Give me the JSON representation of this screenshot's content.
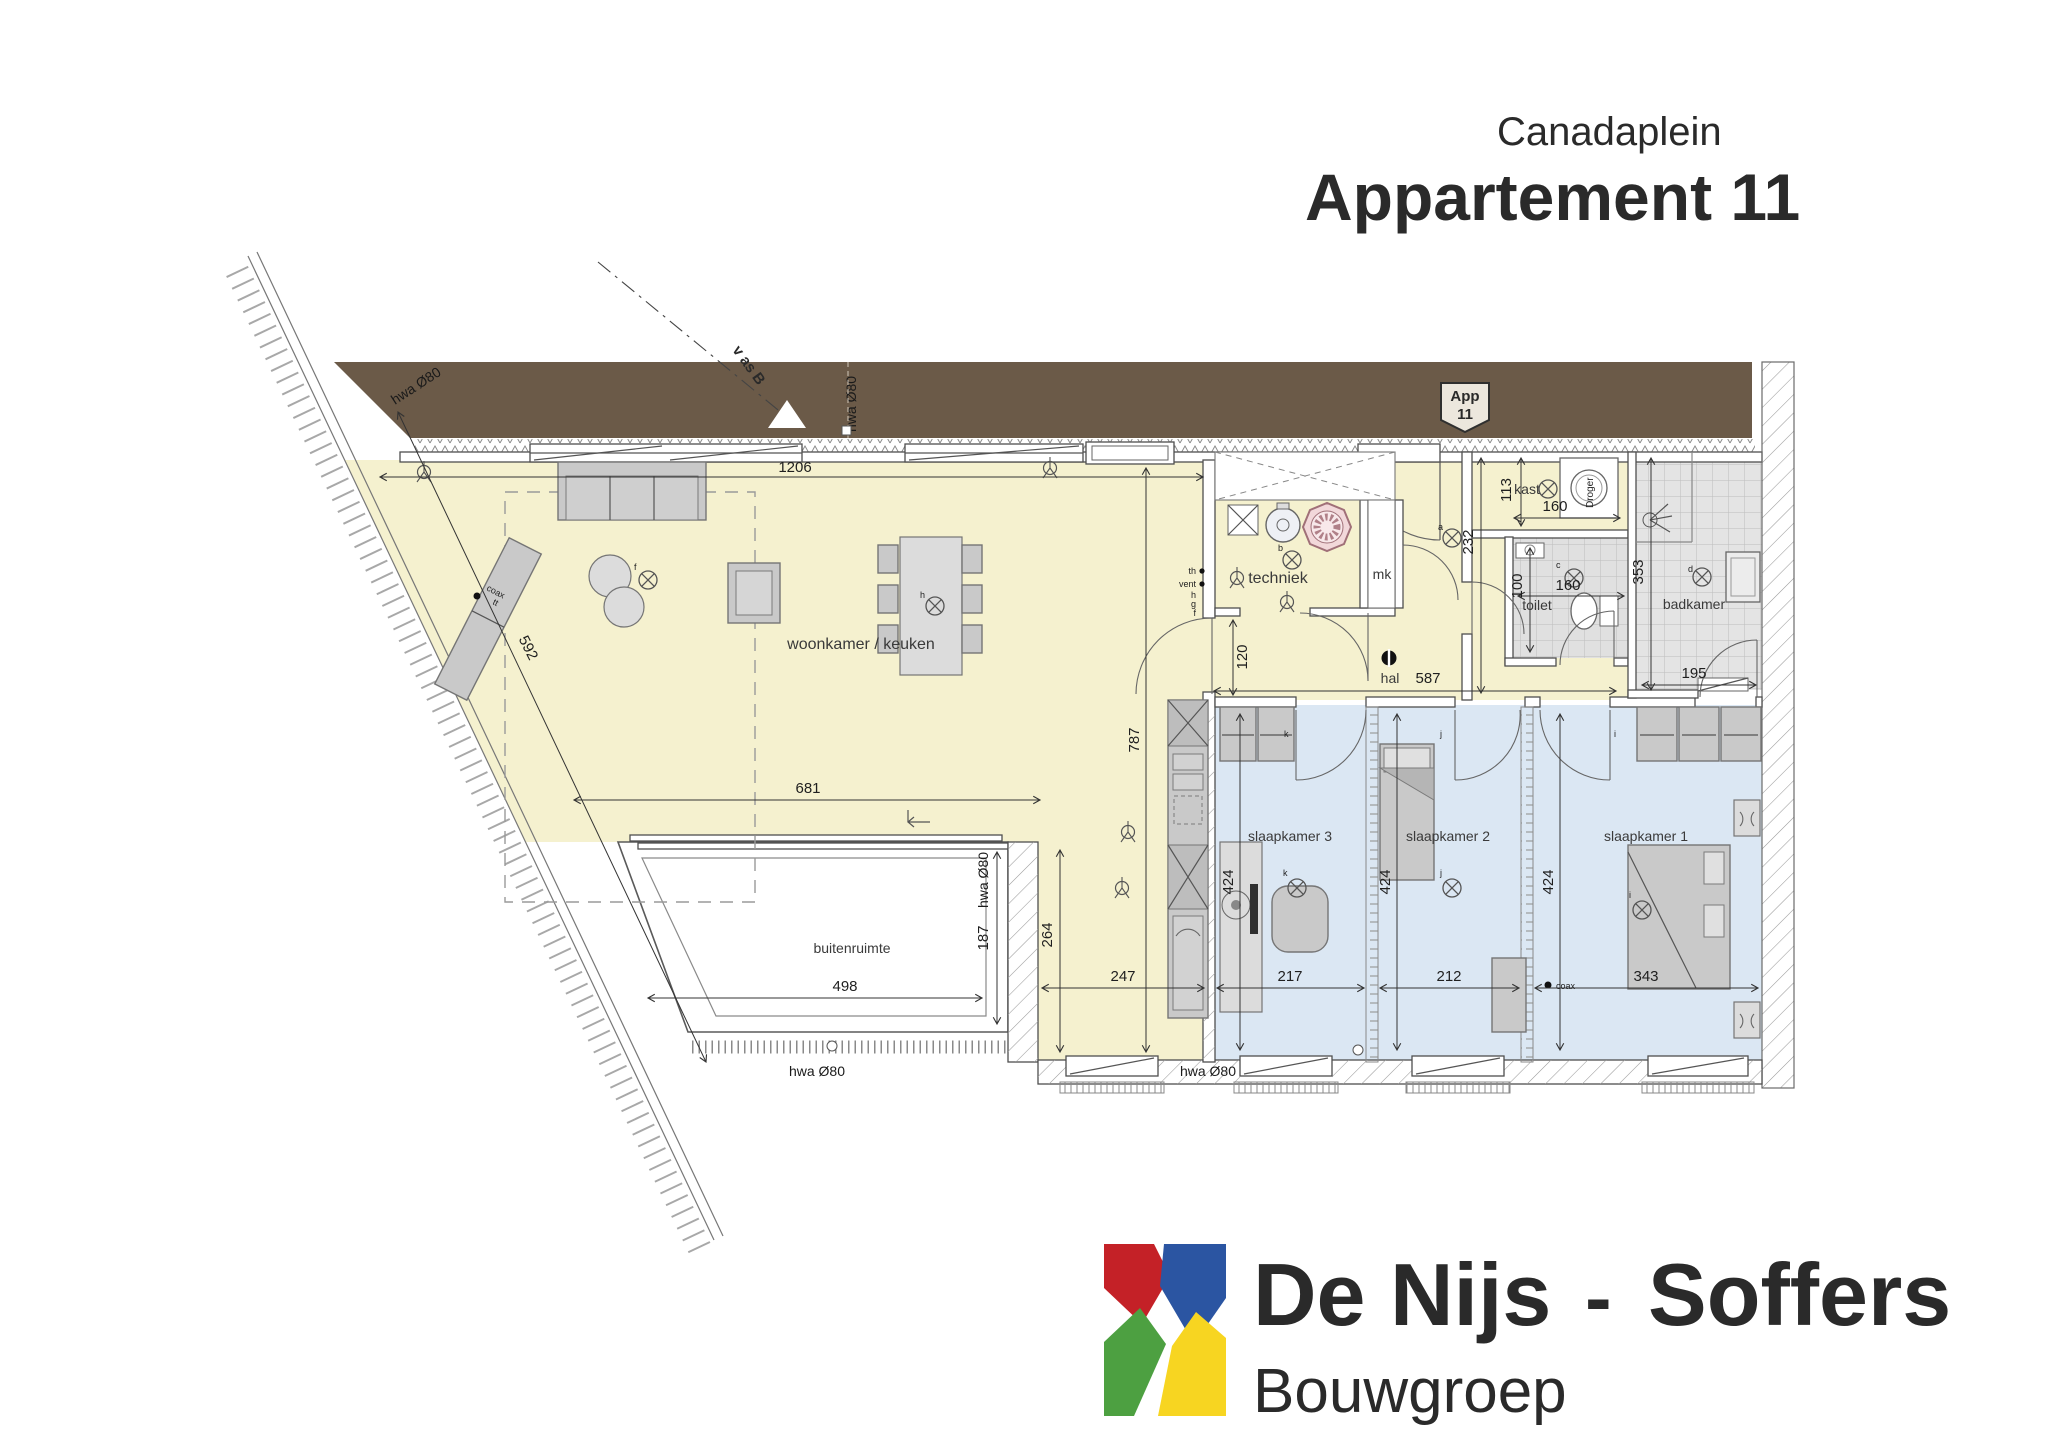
{
  "title": {
    "project": "Canadaplein",
    "apartment": "Appartement 11"
  },
  "badge": {
    "line1": "App",
    "line2": "11"
  },
  "rooms": {
    "woonkamer": "woonkamer / keuken",
    "buitenruimte": "buitenruimte",
    "techniek": "techniek",
    "mk": "mk",
    "hal": "hal",
    "kast": "kast",
    "toilet": "toilet",
    "badkamer": "badkamer",
    "slaapkamer1": "slaapkamer 1",
    "slaapkamer2": "slaapkamer 2",
    "slaapkamer3": "slaapkamer 3",
    "droger": "Droger"
  },
  "dims": {
    "d1206": "1206",
    "d681": "681",
    "d498": "498",
    "d592": "592",
    "d787": "787",
    "d264": "264",
    "d247": "247",
    "d217": "217",
    "d212": "212",
    "d343": "343",
    "d424": "424",
    "d120": "120",
    "d232": "232",
    "d587": "587",
    "d113": "113",
    "d160": "160",
    "d100": "100",
    "d353": "353",
    "d195": "195",
    "d187": "187"
  },
  "annotations": {
    "hwa": "hwa Ø80",
    "axis_label": "v as B",
    "coax": "coax",
    "tt": "tt",
    "th": "th",
    "vent": "vent",
    "h": "h",
    "g": "g",
    "f": "f",
    "a": "a",
    "b": "b",
    "c": "c",
    "d": "d",
    "i": "i",
    "j": "j",
    "k": "k"
  },
  "logo": {
    "name_primary": "De Nijs",
    "separator": "-",
    "name_secondary": "Soffers",
    "subtitle": "Bouwgroep"
  },
  "colors": {
    "corridor_brown": "#6b5a48",
    "living_yellow": "#f5f1cf",
    "bedroom_blue": "#dbe7f3",
    "tile_gray": "#e3e3e3",
    "unit_pink": "#f2d8da",
    "logo_red": "#c42127",
    "logo_blue": "#2b55a2",
    "logo_green": "#4da041",
    "logo_yellow": "#f7d521"
  }
}
